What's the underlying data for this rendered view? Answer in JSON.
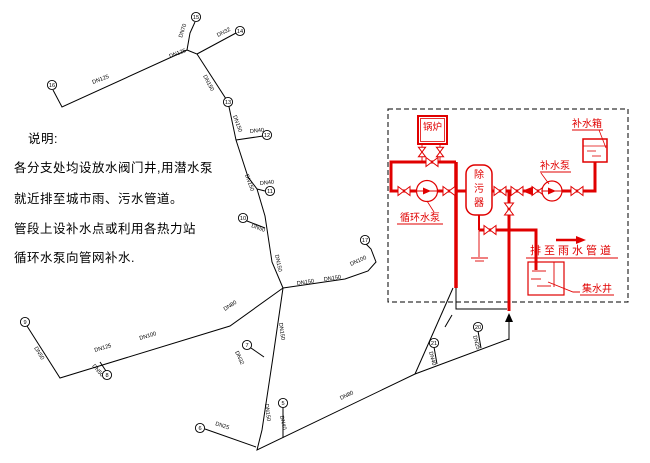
{
  "notes": {
    "heading": "说明:",
    "lines": [
      "各分支处均设放水阀门井,用潜水泵",
      "就近排至城市雨、污水管道。",
      "管段上设补水点或利用各热力站",
      "循环水泵向管网补水."
    ]
  },
  "station": {
    "boiler": "锅炉",
    "makeup_tank": "补水箱",
    "makeup_pump": "补水泵",
    "strainer_chars": [
      "除",
      "污",
      "器"
    ],
    "circulation_pump": "循环水泵",
    "discharge": "排至雨水管道",
    "sump": "集水井",
    "color": "#e00000",
    "valves": [
      {
        "x": 432,
        "y": 162,
        "o": "h",
        "s": 1
      },
      {
        "x": 422,
        "y": 152,
        "o": "v",
        "s": 0.8
      },
      {
        "x": 440,
        "y": 152,
        "o": "v",
        "s": 0.8
      },
      {
        "x": 404,
        "y": 191,
        "o": "h",
        "s": 1
      },
      {
        "x": 449,
        "y": 191,
        "o": "h",
        "s": 1
      },
      {
        "x": 500,
        "y": 191,
        "o": "h",
        "s": 1
      },
      {
        "x": 517,
        "y": 191,
        "o": "h",
        "s": 1
      },
      {
        "x": 538,
        "y": 191,
        "o": "h",
        "s": 1
      },
      {
        "x": 577,
        "y": 191,
        "o": "h",
        "s": 1
      },
      {
        "x": 509,
        "y": 209,
        "o": "v",
        "s": 1
      },
      {
        "x": 490,
        "y": 230,
        "o": "h",
        "s": 1
      }
    ]
  },
  "network": {
    "color": "#000000",
    "nodes": [
      {
        "n": "16",
        "x": 52,
        "y": 85
      },
      {
        "n": "15",
        "x": 196,
        "y": 17
      },
      {
        "n": "14",
        "x": 240,
        "y": 31
      },
      {
        "n": "13",
        "x": 228,
        "y": 102
      },
      {
        "n": "12",
        "x": 267,
        "y": 135
      },
      {
        "n": "11",
        "x": 270,
        "y": 191
      },
      {
        "n": "10",
        "x": 243,
        "y": 218
      },
      {
        "n": "9",
        "x": 25,
        "y": 322
      },
      {
        "n": "8",
        "x": 107,
        "y": 375
      },
      {
        "n": "7",
        "x": 247,
        "y": 345
      },
      {
        "n": "6",
        "x": 200,
        "y": 428
      },
      {
        "n": "5",
        "x": 283,
        "y": 403
      },
      {
        "n": "17",
        "x": 365,
        "y": 240
      },
      {
        "n": "21",
        "x": 434,
        "y": 343
      },
      {
        "n": "20",
        "x": 478,
        "y": 327
      }
    ],
    "pipes": [
      [
        [
          53,
          90
        ],
        [
          62,
          107
        ],
        [
          187,
          50
        ]
      ],
      [
        [
          187,
          50
        ],
        [
          190,
          33
        ],
        [
          195,
          22
        ]
      ],
      [
        [
          187,
          50
        ],
        [
          197,
          54
        ],
        [
          228,
          102
        ],
        [
          236,
          140
        ],
        [
          248,
          177
        ],
        [
          257,
          189
        ],
        [
          265,
          216
        ],
        [
          272,
          262
        ],
        [
          283,
          288
        ]
      ],
      [
        [
          197,
          54
        ],
        [
          236,
          33
        ]
      ],
      [
        [
          236,
          140
        ],
        [
          263,
          136
        ]
      ],
      [
        [
          257,
          189
        ],
        [
          265,
          191
        ]
      ],
      [
        [
          247,
          221
        ],
        [
          265,
          228
        ]
      ],
      [
        [
          283,
          288
        ],
        [
          230,
          326
        ],
        [
          60,
          378
        ],
        [
          27,
          326
        ]
      ],
      [
        [
          100,
          362
        ],
        [
          106,
          371
        ]
      ],
      [
        [
          283,
          288
        ],
        [
          273,
          357
        ],
        [
          262,
          430
        ],
        [
          257,
          450
        ],
        [
          415,
          374
        ],
        [
          509,
          339
        ]
      ],
      [
        [
          251,
          348
        ],
        [
          264,
          357
        ]
      ],
      [
        [
          205,
          429
        ],
        [
          256,
          447
        ]
      ],
      [
        [
          283,
          407
        ],
        [
          283,
          438
        ]
      ],
      [
        [
          283,
          288
        ],
        [
          345,
          279
        ],
        [
          368,
          271
        ],
        [
          376,
          262
        ],
        [
          371,
          249
        ],
        [
          366,
          244
        ]
      ],
      [
        [
          415,
          374
        ],
        [
          453,
          288
        ]
      ],
      [
        [
          445,
          327
        ],
        [
          452,
          315
        ]
      ],
      [
        [
          434,
          347
        ],
        [
          437,
          364
        ]
      ],
      [
        [
          478,
          331
        ],
        [
          481,
          348
        ]
      ],
      [
        [
          456,
          288
        ],
        [
          456,
          309
        ],
        [
          507,
          309
        ]
      ]
    ],
    "labels": [
      {
        "t": "DN125",
        "x": 93,
        "y": 84,
        "r": -21
      },
      {
        "t": "DN125",
        "x": 170,
        "y": 58,
        "r": -21
      },
      {
        "t": "DN70",
        "x": 182,
        "y": 38,
        "r": -72
      },
      {
        "t": "DN32",
        "x": 218,
        "y": 37,
        "r": -27
      },
      {
        "t": "DN150",
        "x": 203,
        "y": 76,
        "r": 62
      },
      {
        "t": "DN150",
        "x": 233,
        "y": 116,
        "r": 70
      },
      {
        "t": "DN40",
        "x": 250,
        "y": 133,
        "r": -6
      },
      {
        "t": "DN150",
        "x": 245,
        "y": 175,
        "r": 70
      },
      {
        "t": "DN40",
        "x": 260,
        "y": 185,
        "r": -6
      },
      {
        "t": "DN50",
        "x": 251,
        "y": 227,
        "r": 20
      },
      {
        "t": "DN150",
        "x": 275,
        "y": 255,
        "r": 78
      },
      {
        "t": "DN80",
        "x": 225,
        "y": 311,
        "r": -33
      },
      {
        "t": "DN100",
        "x": 140,
        "y": 340,
        "r": -17
      },
      {
        "t": "DN125",
        "x": 95,
        "y": 352,
        "r": -17
      },
      {
        "t": "DN50",
        "x": 34,
        "y": 348,
        "r": 58
      },
      {
        "t": "DN50",
        "x": 92,
        "y": 366,
        "r": 50
      },
      {
        "t": "DN32",
        "x": 235,
        "y": 352,
        "r": 65
      },
      {
        "t": "DN150",
        "x": 279,
        "y": 323,
        "r": 82
      },
      {
        "t": "DN150",
        "x": 265,
        "y": 404,
        "r": 83
      },
      {
        "t": "DN25",
        "x": 215,
        "y": 425,
        "r": 18
      },
      {
        "t": "DN150",
        "x": 297,
        "y": 285,
        "r": -8
      },
      {
        "t": "DN150",
        "x": 324,
        "y": 281,
        "r": -8
      },
      {
        "t": "DN100",
        "x": 351,
        "y": 266,
        "r": -25
      },
      {
        "t": "DN40",
        "x": 280,
        "y": 416,
        "r": 78
      },
      {
        "t": "DN80",
        "x": 341,
        "y": 400,
        "r": -26
      },
      {
        "t": "DN40",
        "x": 429,
        "y": 352,
        "r": 75
      },
      {
        "t": "DN25",
        "x": 473,
        "y": 336,
        "r": 75
      }
    ]
  }
}
